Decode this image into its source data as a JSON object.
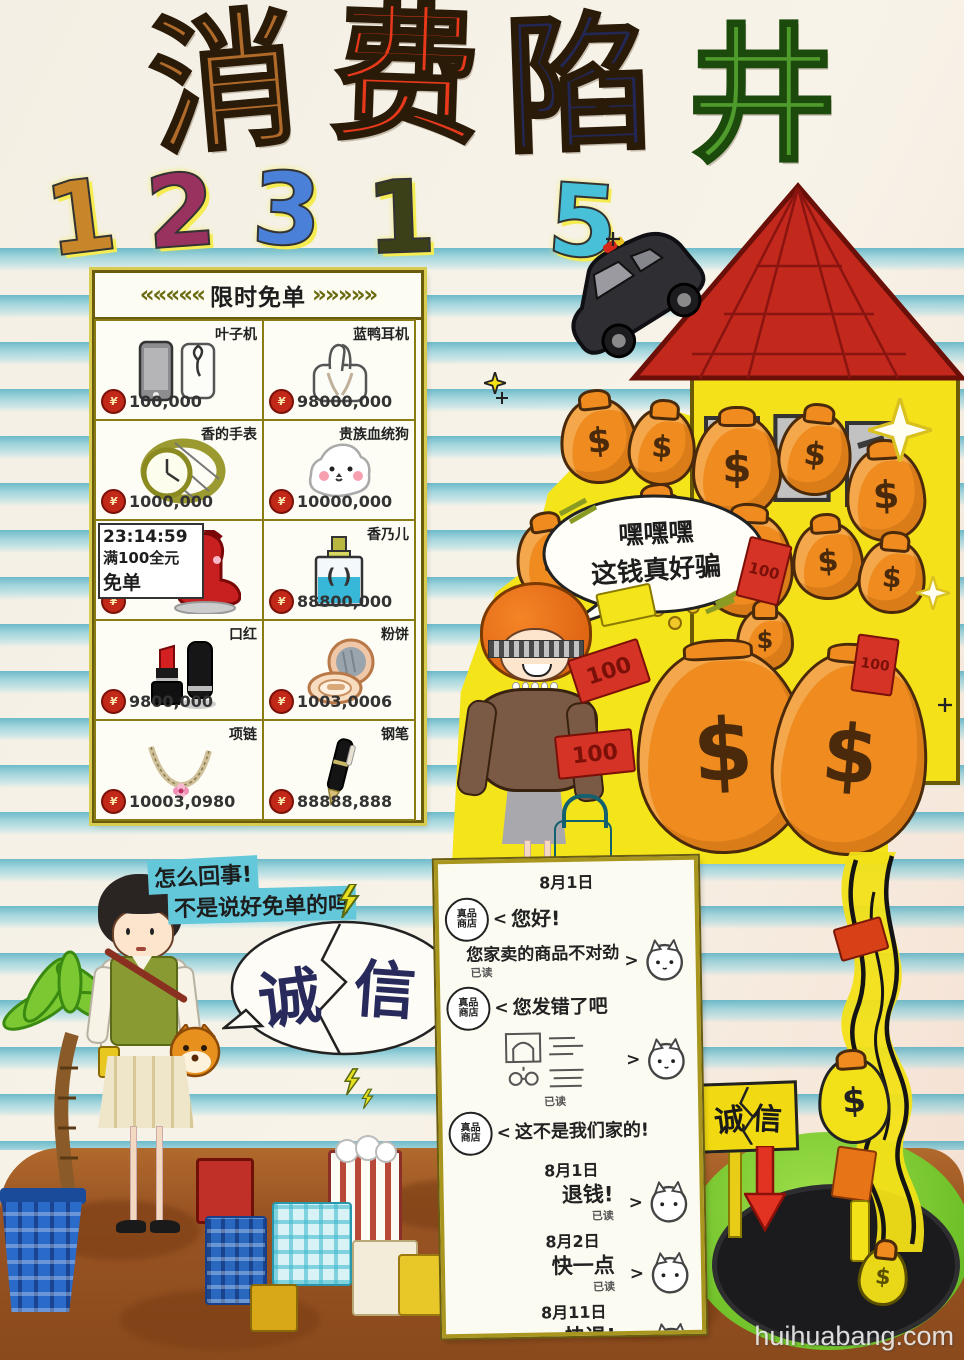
{
  "watermark": "huihuabang.com",
  "title": {
    "c1": "消",
    "c2": "费",
    "c3": "陷",
    "c4": "井"
  },
  "hotline": {
    "d1": "1",
    "d2": "2",
    "d3": "3",
    "d4": "1",
    "d5": "5"
  },
  "flash_sale": {
    "arrows_left": "«««««",
    "arrows_right": "»»»»»",
    "header": "限时免单",
    "currency": "¥",
    "items": [
      {
        "name": "叶子机",
        "price": "100,000"
      },
      {
        "name": "蓝鸭耳机",
        "price": "98000,000"
      },
      {
        "name": "香的手表",
        "price": "1000,000"
      },
      {
        "name": "贵族血统狗",
        "price": "10000,000"
      },
      {
        "name": "免单",
        "timer": "23:14:59",
        "condition": "满100全元",
        "price": ""
      },
      {
        "name": "香乃儿",
        "price": "88800,000",
        "logo": "( )"
      },
      {
        "name": "口红",
        "price": "9800,000"
      },
      {
        "name": "粉饼",
        "price": "1003,0006"
      },
      {
        "name": "项链",
        "price": "10003,0980"
      },
      {
        "name": "钢笔",
        "price": "88888,888"
      }
    ]
  },
  "scene": {
    "villain_line1": "嘿嘿嘿",
    "villain_line2": "这钱真好骗",
    "dollar": "$",
    "note_value": "100"
  },
  "victim": {
    "line1": "怎么回事!",
    "line2": "不是说好免单的吗",
    "broken_left": "诚",
    "broken_right": "信"
  },
  "chat": {
    "shop_top": "真品",
    "shop_bottom": "商店",
    "date1": "8月1日",
    "hello": "您好!",
    "complaint": "您家卖的商品不对劲",
    "read": "已读",
    "wrong": "您发错了吧",
    "not_ours": "这不是我们家的!",
    "date2": "8月1日",
    "refund": "退钱!",
    "date3": "8月2日",
    "hurry": "快一点",
    "date4": "8月11日",
    "refund2": "快退!",
    "chev": "<",
    "arrow": ">"
  },
  "pit": {
    "sign_left": "诚",
    "sign_right": "信",
    "dollar": "$"
  }
}
